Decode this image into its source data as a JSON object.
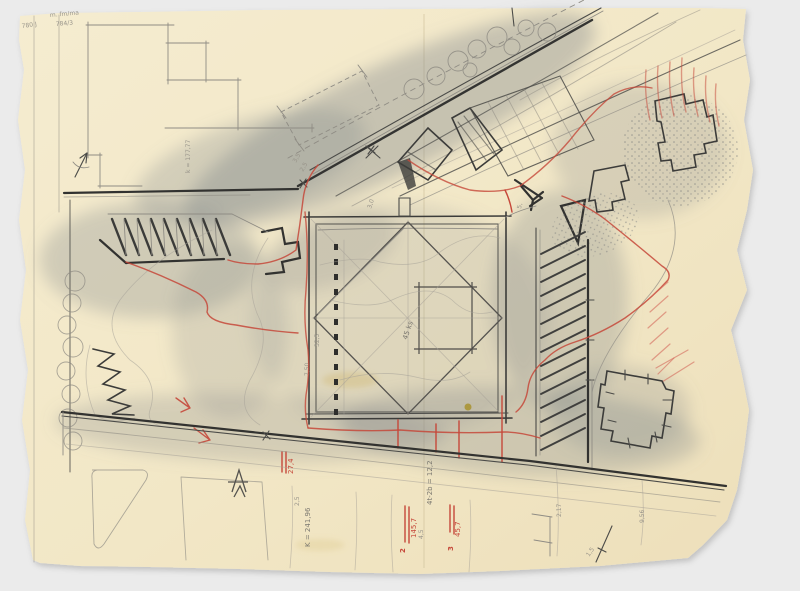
{
  "palette": {
    "background": "#ebebeb",
    "paper": "#f3e8c8",
    "pencil": "#4b4b48",
    "pencil_dark": "#323230",
    "pencil_faint": "#8f8c84",
    "red_pencil": "#c6483a",
    "graphite_smudge": "#7e8488",
    "stain_yellow": "#c8ad52"
  },
  "annotations": {
    "top_note_1": "m. fm/ma",
    "top_note_2": "784/3",
    "top_note_3": "780 J",
    "margin_k": "k = 177,77",
    "road_dim_a": "2,5",
    "road_dim_b": "3,5",
    "square_top_dim": "3,0",
    "square_top_right_dim": "5,",
    "square_center_label": "45 ks",
    "dots_dim_a": "32,5",
    "dots_dim_b": "7,50",
    "bottom_k": "K = 241,96",
    "bottom_25": "2,5",
    "mid_equation": "4t-2b = 12,2",
    "dim_45": "4,5",
    "red_area_1": "145,7",
    "red_no_2": "2",
    "red_area_2": "45,7",
    "red_no_3": "3",
    "red_area_3": "27,4",
    "dim_2_17": "2,17",
    "dim_9_56": "9,56",
    "dim_1_5": "1,5"
  }
}
